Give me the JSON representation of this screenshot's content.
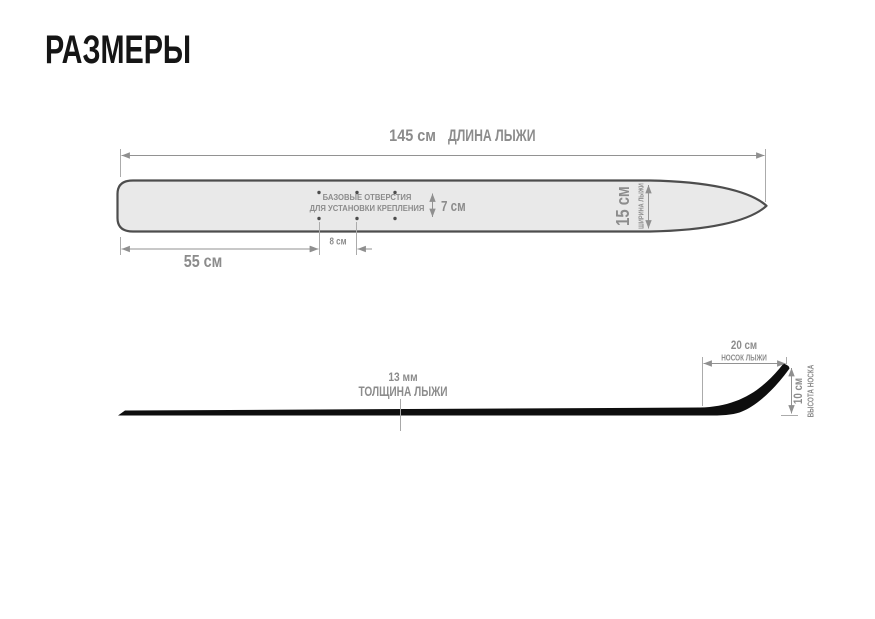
{
  "title": "РАЗМЕРЫ",
  "colors": {
    "background": "#ffffff",
    "title_text": "#151515",
    "label_gray": "#8c8c8c",
    "dimension_line_gray": "#929292",
    "ski_top_fill": "#e9e9e9",
    "ski_top_stroke": "#4d4d4d",
    "ski_side_black": "#0e0e0e"
  },
  "top_view": {
    "length_value": "145 см",
    "length_caption": "ДЛИНА ЛЫЖИ",
    "tail_section_value": "55 см",
    "hole_spacing_value": "8 см",
    "hole_rows_gap_value": "7 см",
    "width_value": "15 см",
    "width_caption": "ШИРИНА ЛЫЖИ",
    "holes_note_line1": "БАЗОВЫЕ ОТВЕРСТИЯ",
    "holes_note_line2": "ДЛЯ УСТАНОВКИ КРЕПЛЕНИЯ"
  },
  "side_view": {
    "thickness_value": "13 мм",
    "thickness_caption": "ТОЛЩИНА ЛЫЖИ",
    "tip_length_value": "20 см",
    "tip_length_caption": "НОСОК ЛЫЖИ",
    "tip_height_value": "10 см",
    "tip_height_caption": "ВЫСОТА НОСКА"
  }
}
